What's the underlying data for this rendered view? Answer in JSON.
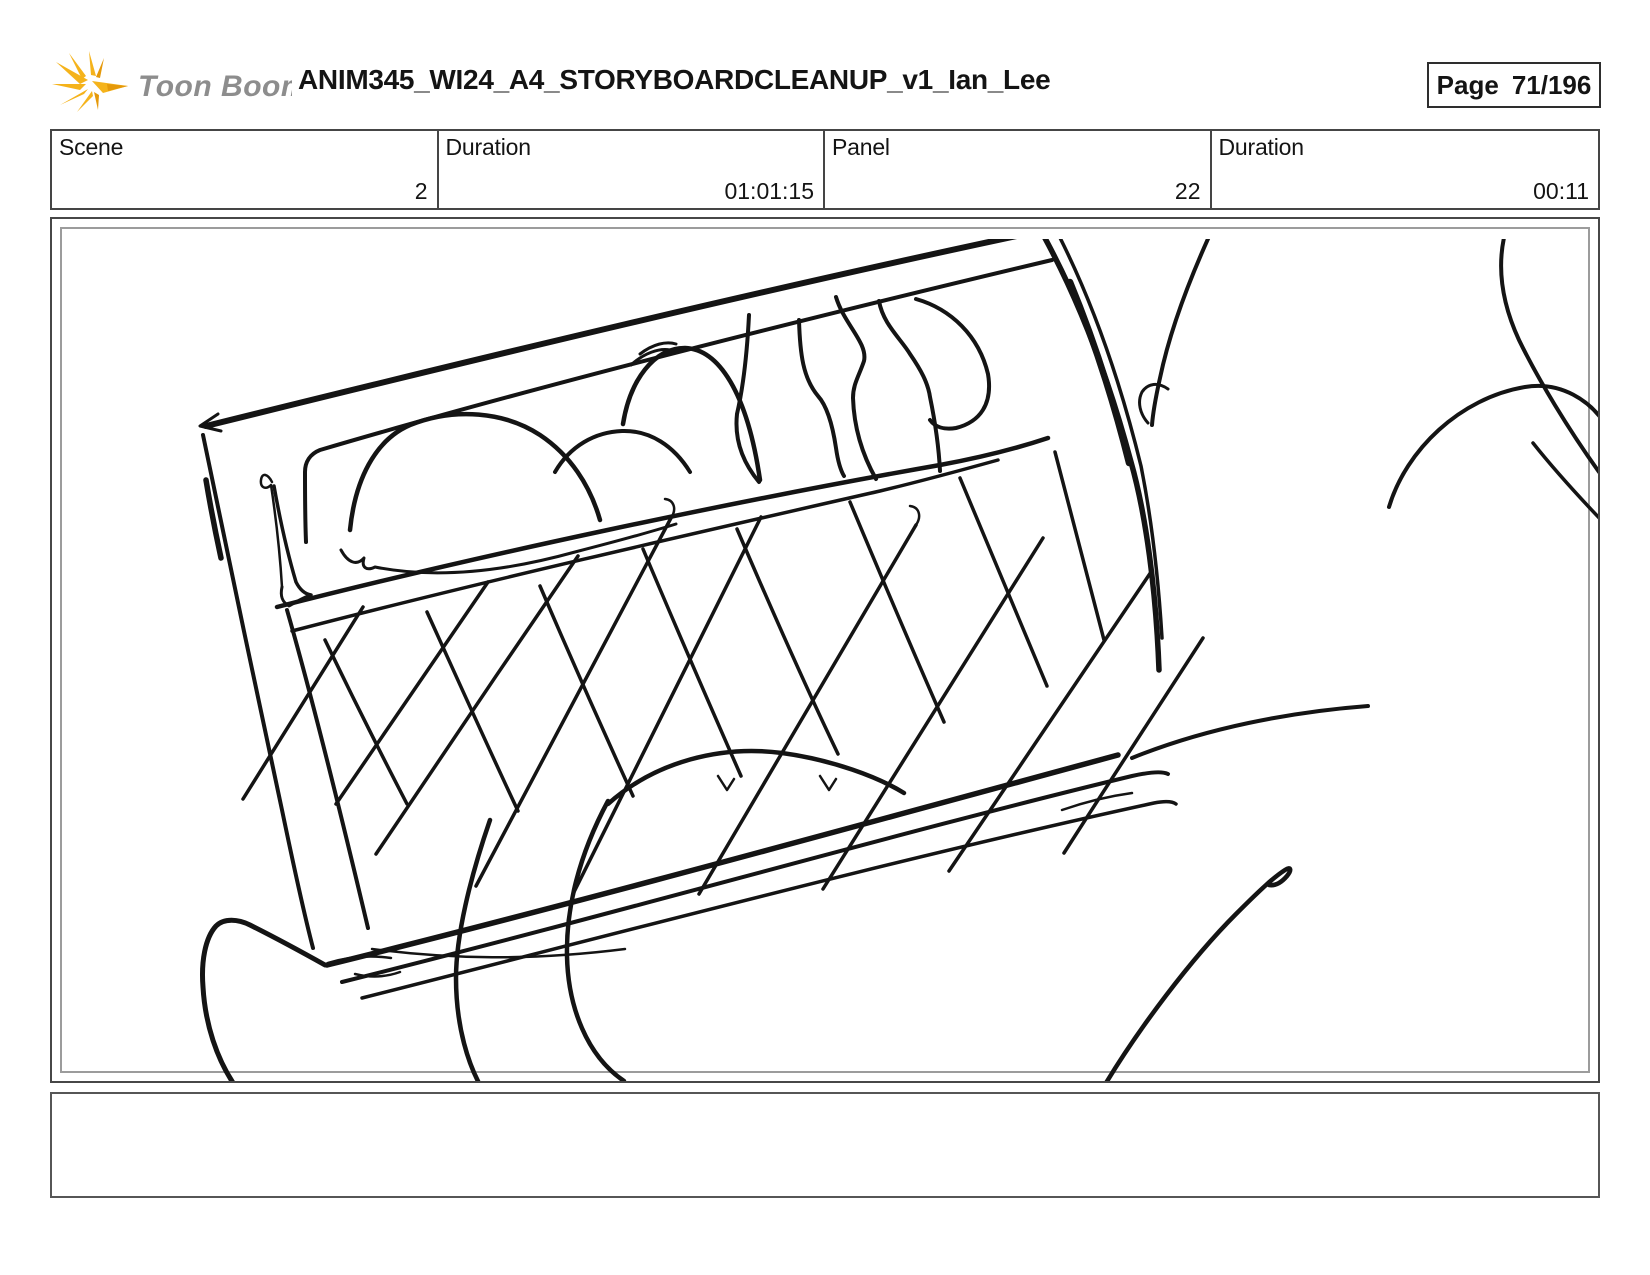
{
  "logo": {
    "text": "Toon Boom",
    "icon": "starburst-icon",
    "accent_yellow": "#f5b31b",
    "accent_orange": "#e5990a",
    "text_gray": "#8d8d8d"
  },
  "header": {
    "title": "ANIM345_WI24_A4_STORYBOARDCLEANUP_v1_Ian_Lee",
    "page": {
      "label": "Page",
      "value": "71/196"
    }
  },
  "inforow": {
    "cells": [
      {
        "label": "Scene",
        "value": "2"
      },
      {
        "label": "Duration",
        "value": "01:01:15"
      },
      {
        "label": "Panel",
        "value": "22"
      },
      {
        "label": "Duration",
        "value": "00:11"
      }
    ]
  },
  "sketch": {
    "description": "storyboard-panel-drawing",
    "ink_color": "#141414"
  },
  "caption": {
    "text": ""
  }
}
